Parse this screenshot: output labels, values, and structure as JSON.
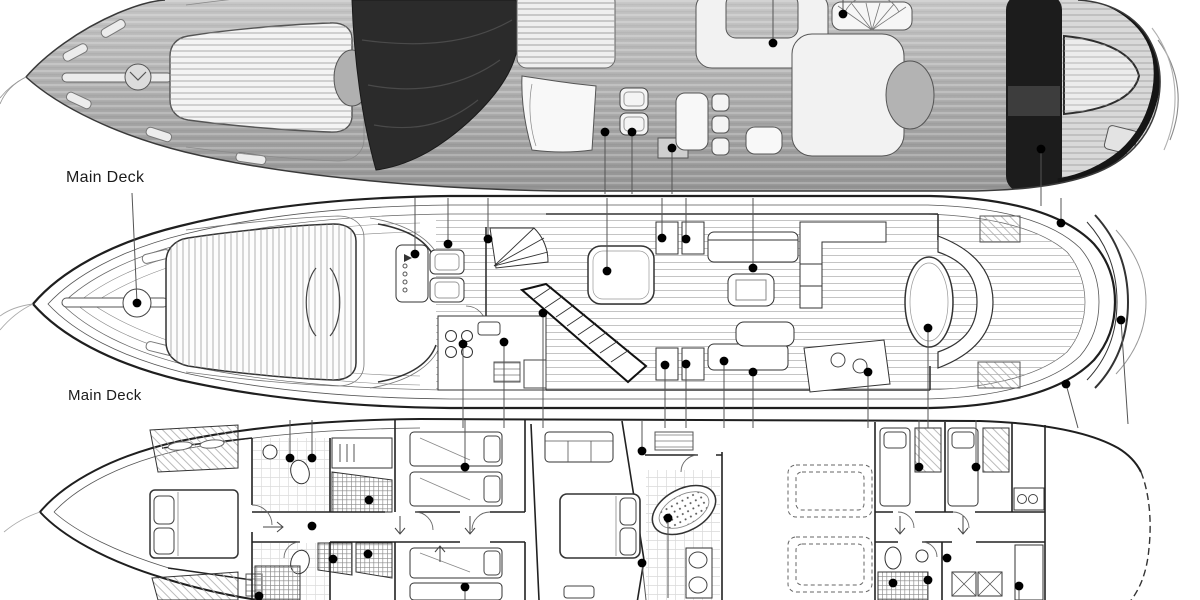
{
  "deck_labels": [
    {
      "text": "Main Deck"
    },
    {
      "text": "Main Deck"
    }
  ],
  "colors": {
    "background": "#ffffff",
    "hull_gray": "#b0b0b0",
    "hull_dark": "#2b2b2b",
    "hardtop_black": "#1c1c1c",
    "linework": "#222222",
    "teak_white": "#f2f2f2",
    "callout_dot": "#000000",
    "leader_line": "#555555"
  },
  "icons": [
    {
      "name": "callout-dot",
      "glyph": "●"
    }
  ],
  "callouts": {
    "top_deck": [
      [
        605,
        132,
        605,
        194
      ],
      [
        632,
        132,
        632,
        194
      ],
      [
        672,
        148,
        672,
        194
      ],
      [
        773,
        43,
        773,
        0
      ],
      [
        843,
        14,
        843,
        0
      ],
      [
        1041,
        149,
        1041,
        206
      ]
    ],
    "main_deck": [
      [
        137,
        303,
        132,
        193
      ],
      [
        415,
        254,
        415,
        198
      ],
      [
        448,
        244,
        448,
        198
      ],
      [
        488,
        239,
        488,
        198
      ],
      [
        607,
        271,
        607,
        198
      ],
      [
        662,
        238,
        662,
        198
      ],
      [
        686,
        239,
        686,
        198
      ],
      [
        753,
        268,
        753,
        198
      ],
      [
        1061,
        223,
        1061,
        198
      ],
      [
        463,
        344,
        463,
        428
      ],
      [
        504,
        342,
        504,
        428
      ],
      [
        543,
        313,
        543,
        428
      ],
      [
        665,
        365,
        665,
        428
      ],
      [
        686,
        364,
        686,
        428
      ],
      [
        724,
        361,
        724,
        428
      ],
      [
        753,
        372,
        753,
        428
      ],
      [
        868,
        372,
        868,
        428
      ],
      [
        928,
        328,
        928,
        428
      ],
      [
        1066,
        384,
        1078,
        428
      ],
      [
        1121,
        320,
        1128,
        424
      ]
    ],
    "lower_deck": [
      [
        290,
        458,
        290,
        420
      ],
      [
        312,
        458,
        312,
        420
      ],
      [
        369,
        500,
        369,
        500
      ],
      [
        333,
        559,
        333,
        559
      ],
      [
        368,
        554,
        368,
        554
      ],
      [
        259,
        596,
        259,
        600
      ],
      [
        312,
        526,
        312,
        526
      ],
      [
        465,
        467,
        465,
        420
      ],
      [
        642,
        451,
        642,
        420
      ],
      [
        668,
        518,
        668,
        598
      ],
      [
        642,
        563,
        646,
        600
      ],
      [
        465,
        587,
        465,
        600
      ],
      [
        919,
        467,
        919,
        420
      ],
      [
        976,
        467,
        976,
        420
      ],
      [
        947,
        558,
        947,
        558
      ],
      [
        928,
        580,
        928,
        600
      ],
      [
        893,
        583,
        893,
        583
      ],
      [
        1019,
        586,
        1019,
        600
      ]
    ]
  }
}
